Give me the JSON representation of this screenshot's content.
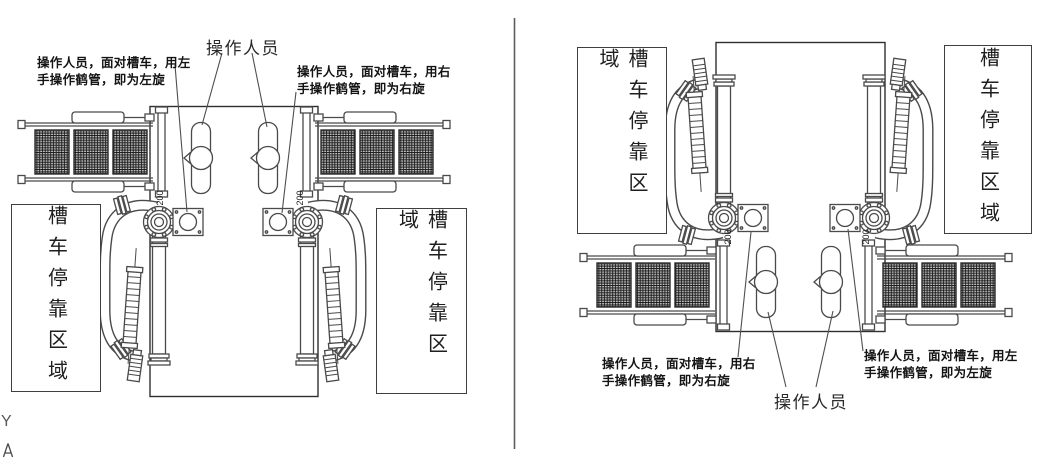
{
  "page": {
    "background": "#ffffff",
    "line_color": "#4a4a4a",
    "text_color": "#1f1f1f"
  },
  "axis_indicator": {
    "label": "Y"
  },
  "views": {
    "left": {
      "operator_label": "操作人员",
      "notes": {
        "left": {
          "line1": "操作人员，面对槽车，用左",
          "line2": "手操作鹤管，即为左旋"
        },
        "right": {
          "line1": "操作人员，面对槽车，用右",
          "line2": "手操作鹤管，即为右旋"
        }
      },
      "zones": {
        "left": "槽车停靠区域",
        "right": "槽车停靠区域"
      },
      "dims": {
        "left": "200",
        "right": "200"
      }
    },
    "right": {
      "operator_label": "操作人员",
      "notes": {
        "left": {
          "line1": "操作人员，面对槽车，用右",
          "line2": "手操作鹤管，即为右旋"
        },
        "right": {
          "line1": "操作人员，面对槽车，用左",
          "line2": "手操作鹤管，即为左旋"
        }
      },
      "zones": {
        "left": "槽车停靠区域",
        "right": "槽车停靠区域"
      },
      "dims": {
        "left": "200",
        "right": "200"
      }
    }
  }
}
